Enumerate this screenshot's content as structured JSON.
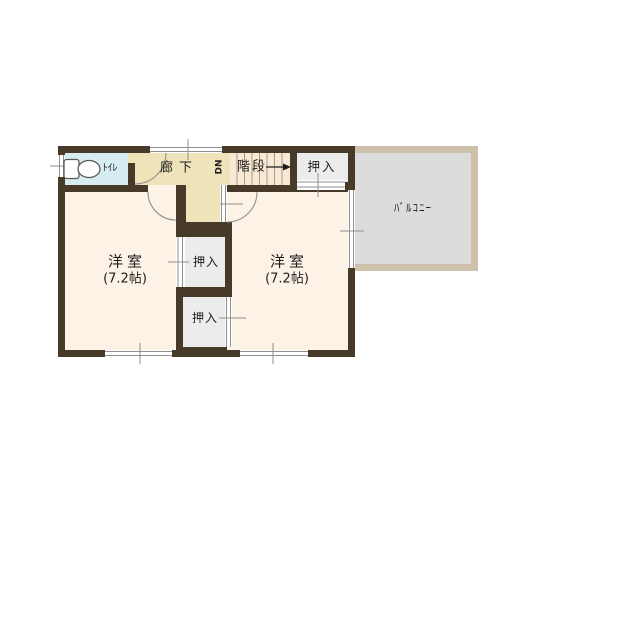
{
  "rooms": {
    "toilet": {
      "label": "ﾄｲﾚ"
    },
    "hallway": {
      "label": "廊下"
    },
    "stairs": {
      "label": "階段",
      "direction": "DN"
    },
    "closet_top": {
      "label": "押入"
    },
    "closet_upper": {
      "label": "押入"
    },
    "closet_lower": {
      "label": "押入"
    },
    "room_left": {
      "label": "洋室",
      "size": "(7.2帖)"
    },
    "room_right": {
      "label": "洋室",
      "size": "(7.2帖)"
    },
    "balcony": {
      "label": "ﾊﾞﾙｺﾆｰ"
    }
  },
  "colors": {
    "wall": "#483a28",
    "room": "#fdf2e6",
    "hall": "#efe3ba",
    "stairs": "#f8e9d4",
    "toilet": "#d6edf2",
    "closet": "#ececec",
    "balcony-floor": "#dcdcdc",
    "balcony-border": "#cdc1ab",
    "line": "#8f8f8f",
    "tread": "#a89a84",
    "text": "#1e1e1e",
    "bg": "#ffffff"
  }
}
